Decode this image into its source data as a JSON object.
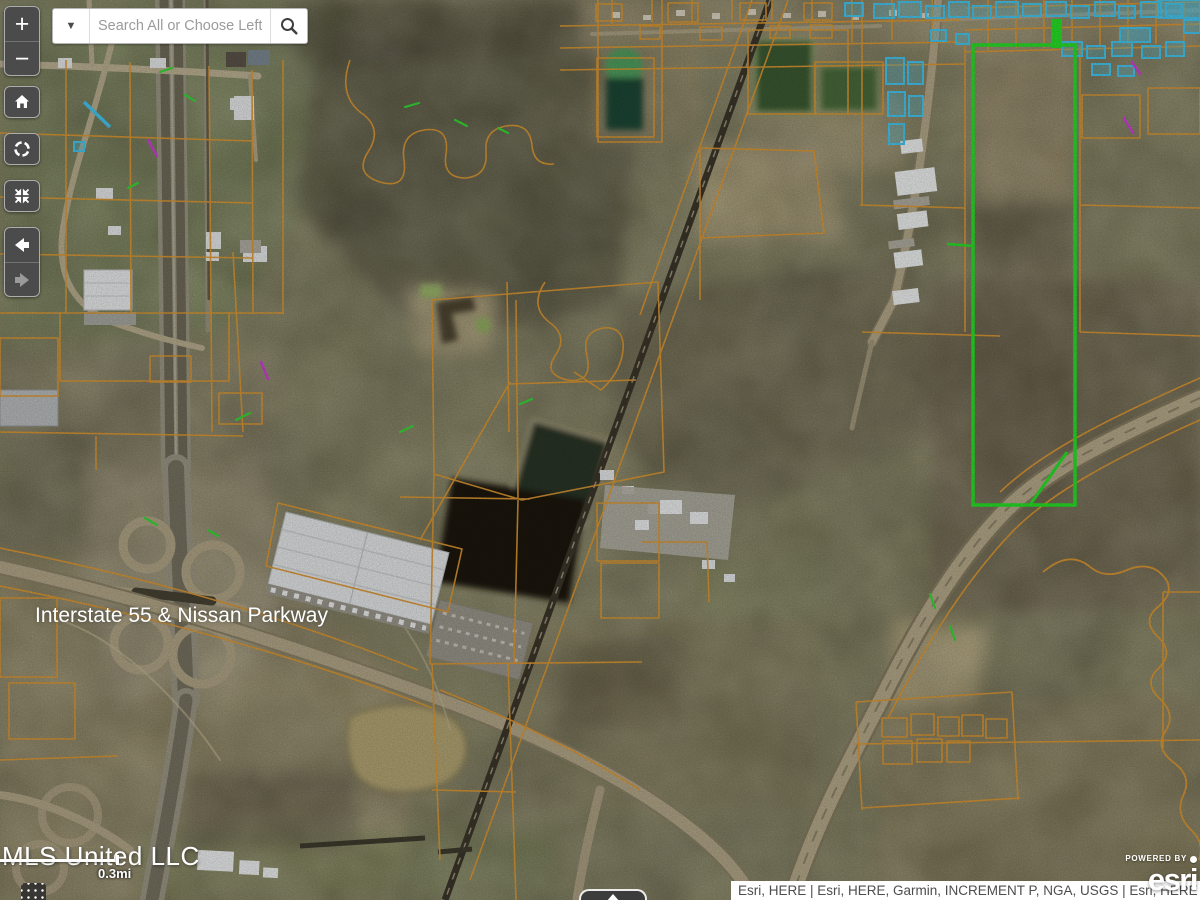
{
  "search": {
    "placeholder": "Search All or Choose Left"
  },
  "toolbar": {
    "zoom_in_label": "+",
    "zoom_out_label": "−"
  },
  "map": {
    "road_label": "Interstate 55 & Nissan Parkway",
    "scale_label": "0.3mi",
    "colors": {
      "parcel_line": "#dd9833",
      "highlighted_parcel": "#27e027",
      "flagged_lots": "#45c6ef",
      "toolbar_background": "#4b4b4b"
    }
  },
  "attribution": {
    "mls": "MLS United LLC",
    "sources": "Esri, HERE | Esri, HERE, Garmin, INCREMENT P, NGA, USGS | Esri, HERE",
    "powered_by": "POWERED BY",
    "esri_logo": "esri"
  }
}
